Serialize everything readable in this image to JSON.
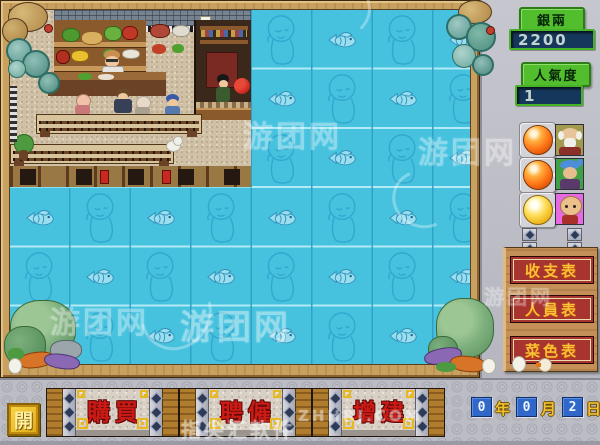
{
  "hud": {
    "money": {
      "label": "銀兩",
      "value": "2200"
    },
    "popularity": {
      "label": "人氣度",
      "value": "1"
    },
    "staff_rows": [
      {
        "button_color": "#FF7818",
        "button_shape": "orange-sphere-button",
        "portrait": "elder-portrait",
        "portrait_bg": "#A29A4E"
      },
      {
        "button_color": "#FF7818",
        "button_shape": "orange-sphere-button",
        "portrait": "blue-hair-portrait",
        "portrait_bg": "#3FA044"
      },
      {
        "button_color": "#F0B820",
        "button_shape": "yellow-sphere-button",
        "portrait": "bald-portrait",
        "portrait_bg": "#E66AE0"
      }
    ],
    "report_buttons": [
      {
        "label": "收支表"
      },
      {
        "label": "人員表"
      },
      {
        "label": "菜色表"
      }
    ]
  },
  "toolbar": {
    "open_label": "開",
    "actions": [
      {
        "label": "購買"
      },
      {
        "label": "聘僱"
      },
      {
        "label": "增建"
      }
    ],
    "date": {
      "year": "0",
      "year_unit": "年",
      "month": "0",
      "month_unit": "月",
      "day": "2",
      "day_unit": "日"
    }
  },
  "map": {
    "grid": {
      "rows": 6,
      "cols": 8,
      "cell_w": 60.5,
      "cell_h": 59.33,
      "restaurant_rows": 3,
      "restaurant_cols": 4,
      "icon_even": "monk-head-tile-icon",
      "icon_odd": "fish-tile-icon"
    }
  },
  "watermarks": [
    {
      "text": "游团网",
      "left": 243,
      "top": 112,
      "size": 30,
      "opacity": 0.38
    },
    {
      "text": "游团网",
      "left": 418,
      "top": 128,
      "size": 30,
      "opacity": 0.38
    },
    {
      "text": "游团网",
      "left": 50,
      "top": 298,
      "size": 30,
      "opacity": 0.38
    },
    {
      "text": "游团网",
      "left": 180,
      "top": 300,
      "size": 34,
      "opacity": 0.42
    },
    {
      "text": "游团网",
      "left": 484,
      "top": 281,
      "size": 20,
      "opacity": 0.35
    },
    {
      "text": "指尖汇软件",
      "left": 181,
      "top": 414,
      "size": 20,
      "opacity": 0.5
    },
    {
      "text": "ZHHRJ.COM",
      "left": 298,
      "top": 407,
      "size": 15,
      "opacity": 0.45
    }
  ],
  "colors": {
    "tile_cyan": "#46C2DF",
    "tile_line_light": "#B8ECF6",
    "tile_line_dark": "#2F9FC6",
    "frame_wood": "#C8A060",
    "panel_gray": "#BEBEC6",
    "plaque_green": "#52BE2E",
    "value_navy": "#16375C",
    "report_red": "#A83430",
    "report_text_gold": "#F6C236",
    "action_red": "#CC1A14",
    "gold": "#E8B820",
    "date_blue": "#2F68C8"
  }
}
